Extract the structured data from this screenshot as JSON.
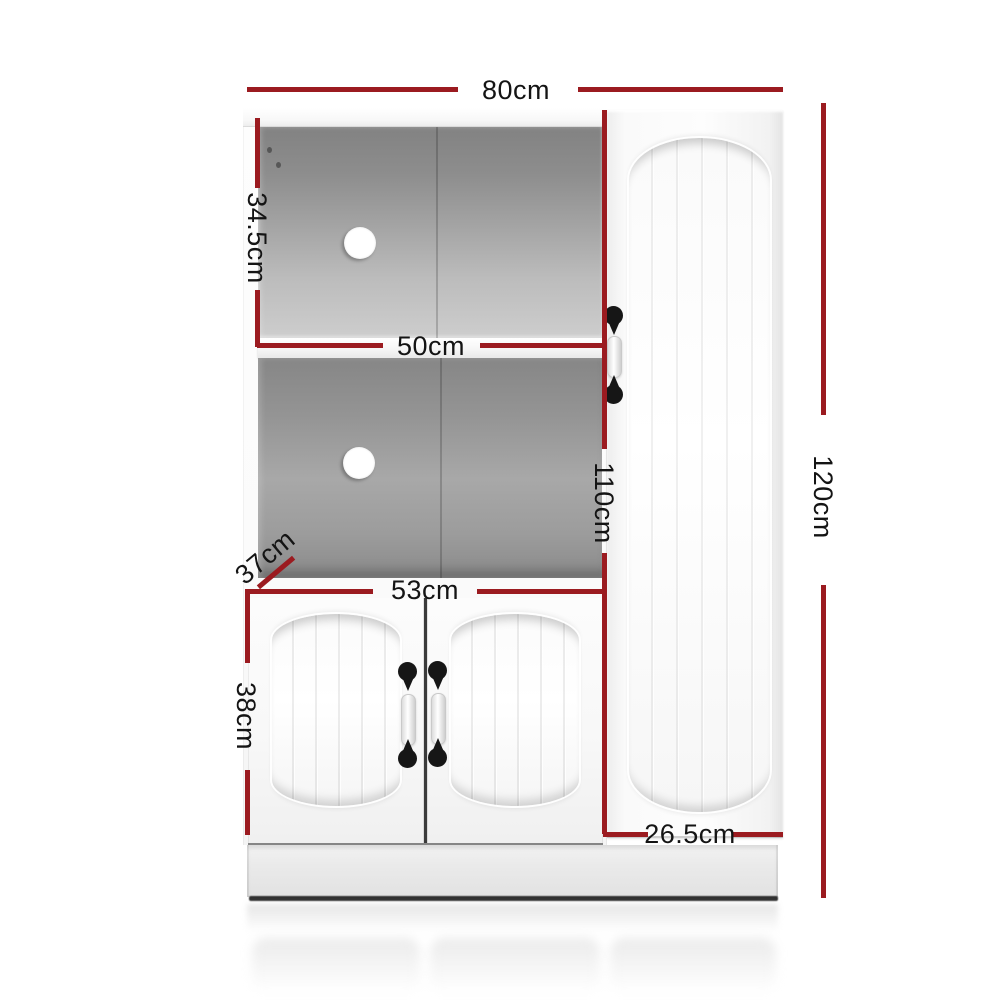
{
  "figure": {
    "type": "product-dimension-diagram",
    "subject": "White buffet sideboard cabinet with two open shelves, two lower doors and a tall side door",
    "unit": "cm"
  },
  "colors": {
    "dimension_line": "#9b1b20",
    "label_text": "#141414",
    "background": "#ffffff"
  },
  "dimensions": {
    "overall_width": "80cm",
    "upper_compartment_height": "34.5cm",
    "shelf_width": "50cm",
    "tall_door_height": "110cm",
    "overall_height": "120cm",
    "depth": "37cm",
    "lower_doors_width": "53cm",
    "lower_doors_height": "38cm",
    "tall_door_width": "26.5cm"
  }
}
